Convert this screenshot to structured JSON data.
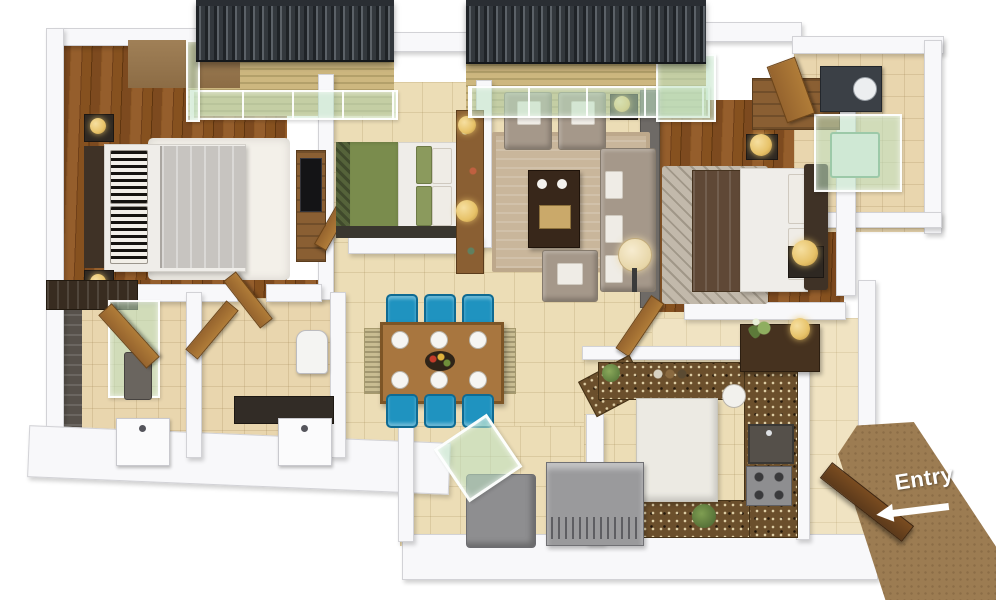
{
  "entry": {
    "label": "Entry",
    "arrow_direction": "left"
  },
  "colors": {
    "background": "#ffffff",
    "wall": "#f8f8fa",
    "wall_edge": "#d2d2d6",
    "tile_cream": "#ecddb6",
    "tile_beige": "#e9d6ae",
    "foyer_tile": "#f0e3c2",
    "dark_tile": "#57514b",
    "balcony_rail": "#33383d",
    "glass_green": "#cde8d2",
    "bed_white": "#efede9",
    "bed_gray": "#c7c4c0",
    "headboard_dark": "#3f3226",
    "green_bed": "#7a8c4d",
    "green_dark": "#55633a",
    "taupe_sofa": "#a5988a",
    "coffee_table": "#38271a",
    "rug_beige": "#c9b69b",
    "rug_white": "#f3f0e9",
    "rug_master": "#c2b9ab",
    "blue_chair": "#1f93c0",
    "dining_wood": "#a8763f",
    "granite": "#6b4f2c",
    "kitchen_white": "#eceae3",
    "entry_path": "#9c7c52",
    "door_brown": "#96642e",
    "door_dark": "#5c3a1b",
    "lamp_gold": "#e7c268",
    "accent_wall": "#6e6a66",
    "appliance_gray": "#9a9a9c",
    "wardrobe_brown": "#8a5f33",
    "tan_wall": "#a08057",
    "wood_floor": "#7d4a1f"
  }
}
